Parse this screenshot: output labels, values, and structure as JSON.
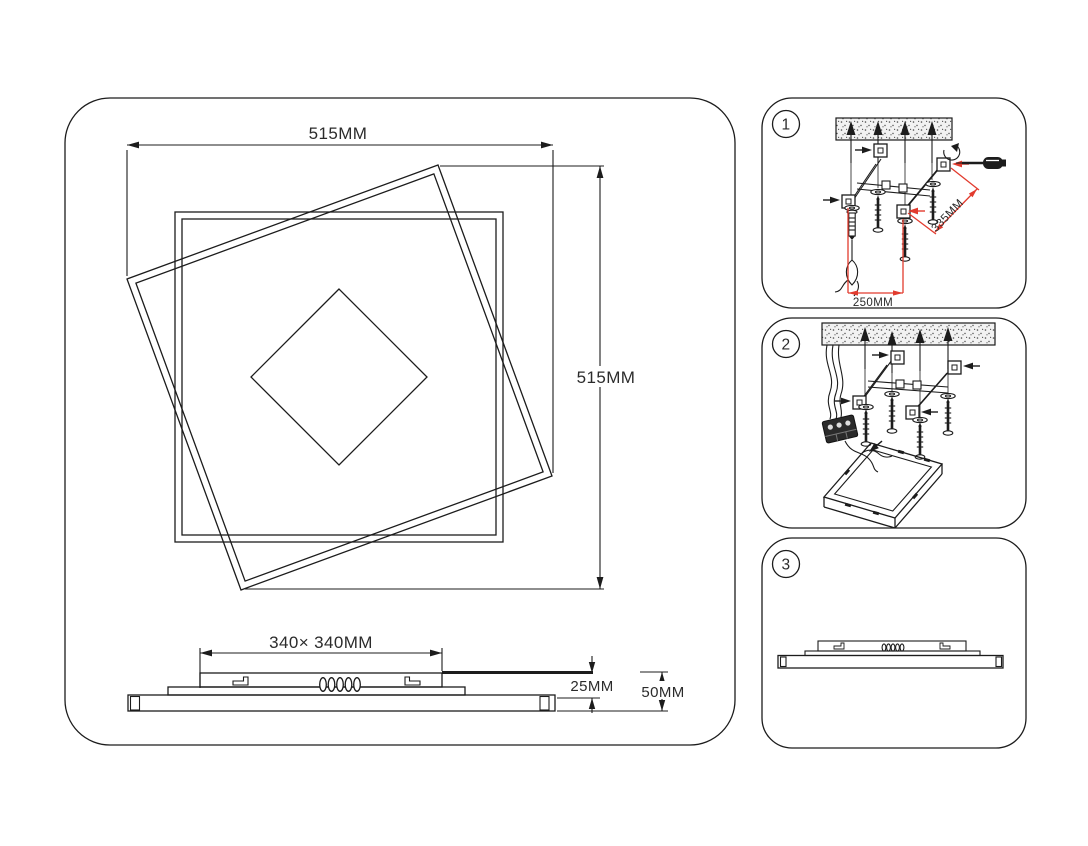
{
  "main": {
    "dim_top": "515MM",
    "dim_right": "515MM",
    "side_view": {
      "dim_width": "340× 340MM",
      "dim_inner_height": "25MM",
      "dim_total_height": "50MM"
    }
  },
  "steps": [
    {
      "number": "1",
      "dim_bracket_length": "335MM",
      "dim_bracket_spacing": "250MM"
    },
    {
      "number": "2"
    },
    {
      "number": "3"
    }
  ],
  "colors": {
    "line": "#1c1c1c",
    "dimension_red": "#e23b2e",
    "background": "#ffffff"
  }
}
